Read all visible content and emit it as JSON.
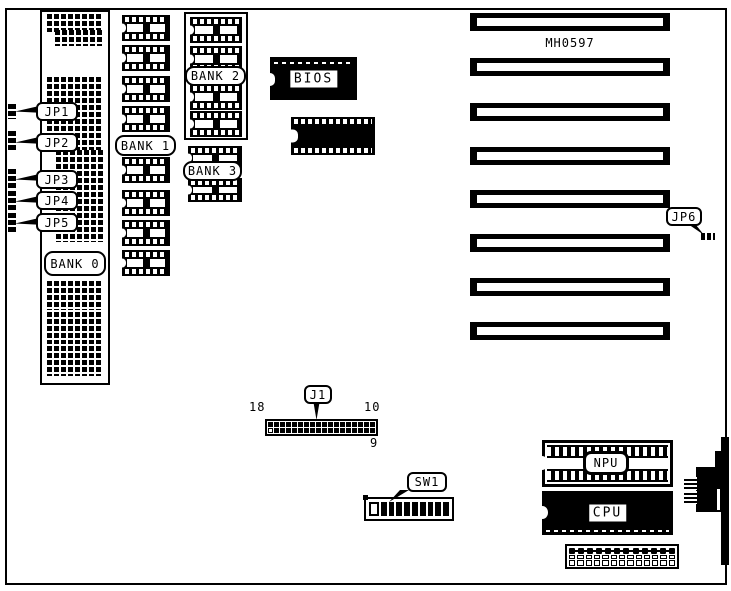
{
  "diagram": {
    "model_number": "MH0597",
    "jumpers": {
      "jp1": "JP1",
      "jp2": "JP2",
      "jp3": "JP3",
      "jp4": "JP4",
      "jp5": "JP5",
      "jp6": "JP6"
    },
    "memory_banks": {
      "bank0": "BANK 0",
      "bank1": "BANK 1",
      "bank2": "BANK 2",
      "bank3": "BANK 3"
    },
    "chips": {
      "bios": "BIOS",
      "npu": "NPU",
      "cpu": "CPU"
    },
    "connectors": {
      "j1": "J1",
      "sw1": "SW1"
    },
    "j1_pin_labels": {
      "left": "18",
      "right_top": "10",
      "right_bottom": "9"
    },
    "colors": {
      "ink": "#000000",
      "paper": "#ffffff"
    }
  }
}
